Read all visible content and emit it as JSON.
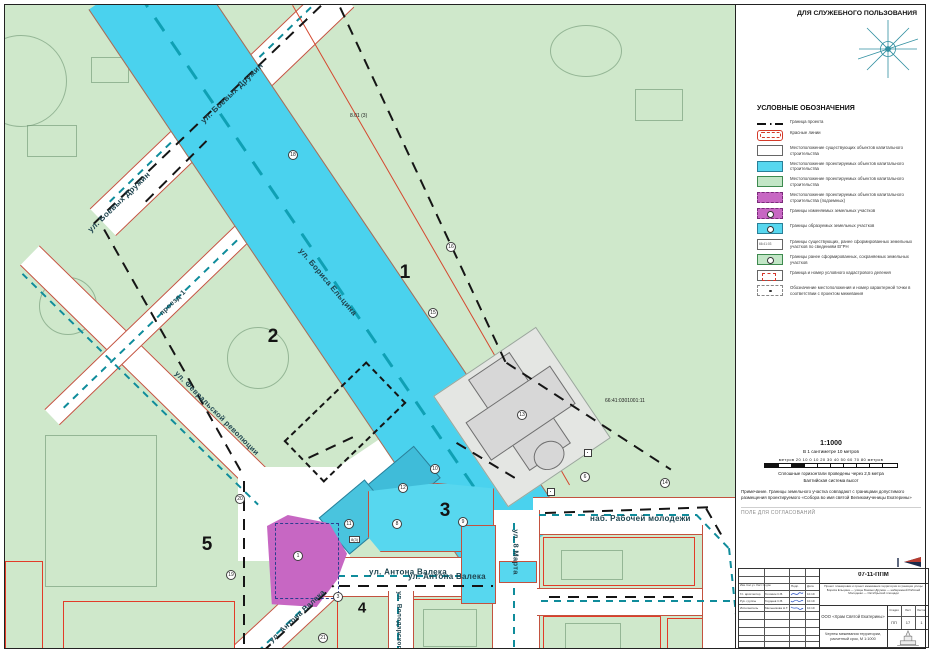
{
  "sheet": {
    "classification": "ДЛЯ СЛУЖЕБНОГО ПОЛЬЗОВАНИЯ"
  },
  "legend": {
    "title": "УСЛОВНЫЕ ОБОЗНАЧЕНИЯ",
    "items": [
      "Граница проекта",
      "Красные линии",
      "Местоположение существующих объектов капитального строительства",
      "Местоположение проектируемых объектов капитального строительства",
      "Местоположение проектируемых объектов капитального строительства",
      "Местоположение проектируемых объектов капитального строительства (подземных)",
      "Границы изменяемых земельных участков",
      "Границы образуемых земельных участков",
      "Границы существующих, ранее сформированных земельных участков по сведениям ЕГРН",
      "Границы ранее сформированных, сохраняемых земельных участков",
      "Граница и номер условного кадастрового деления",
      "Обозначение местоположения и номер характерной точки в соответствии с проектом межевания"
    ]
  },
  "scale": {
    "ratio": "1:1000",
    "subtitle": "В 1 сантиметре 10 метров",
    "bar_labels": "метров 20  10   0   10   20   30   40   50   60   70   80 метров",
    "note1": "Сплошные горизонтали проведены через 2,5 метра",
    "note2": "Балтийская система высот"
  },
  "notes": {
    "note1": "Примечание. Границы земельного участка совпадают с границами допустимого размещения проектируемого",
    "note2": "«Собора во имя святой Великомученицы Екатерины»",
    "approvals": "ПОЛЕ ДЛЯ СОГЛАСОВАНИЙ"
  },
  "map": {
    "streets": [
      "ул. Боевых Дружин",
      "ул. Боевых Дружин",
      "проезд-1",
      "ул. Бориса Ельцина",
      "ул. Февральской революции",
      "ул. Антона Валека",
      "ул. Антона Валека",
      "ул. Володарского",
      "ул. 8 Марта",
      "наб. Рабочей молодежи"
    ],
    "blocks": [
      "1",
      "2",
      "3",
      "4",
      "5"
    ],
    "points": [
      "16",
      "15",
      "18",
      "13",
      "6",
      "10",
      "12",
      "11",
      "8",
      "9",
      "20",
      "19",
      "1",
      "3",
      "21",
      "14"
    ],
    "cadastral_number": "66:41:0301001:11",
    "elevation_label": "8.01 (3)",
    "parcel_label": "8(3)"
  },
  "stamp": {
    "code": "07-11-ППМ",
    "project": "Проект планировки и проект межевания территории в границах улицы Бориса Ельцина — улицы Боевых Дружин — набережной Рабочей Молодежи — Октябрьской площади",
    "company": "ООО «Храм Святой Екатерины»",
    "stage_label": "Стадия",
    "sheet_label": "Лист",
    "sheets_label": "Листов",
    "stage": "ПП",
    "sheet": "17",
    "sheets": "1",
    "drawing_title": "Чертеж межевания территории, расчетный срок, М 1:1000",
    "cols1": "Изм. Кол.уч. Лист № док.",
    "cols2": "Подп.",
    "cols3": "Дата",
    "rows": [
      {
        "role": "Гл. архитектор",
        "name": "Головин С.В.",
        "date": "10.19"
      },
      {
        "role": "Рук. группы",
        "name": "Гордеев С.В.",
        "date": "10.19"
      },
      {
        "role": "Исполнитель",
        "name": "Мельникова Н.Т.",
        "date": "10.19"
      }
    ]
  },
  "colors": {
    "map_green": "#cfe8cb",
    "water_cyan": "#4ad2ee",
    "parcel_cyan": "#57d7ef",
    "parcel_magenta": "#c767c3",
    "red_line": "#d4482f",
    "street_edge": "#c3523f",
    "boundary_black": "#151515",
    "teal_dash": "#0f8c9b"
  }
}
